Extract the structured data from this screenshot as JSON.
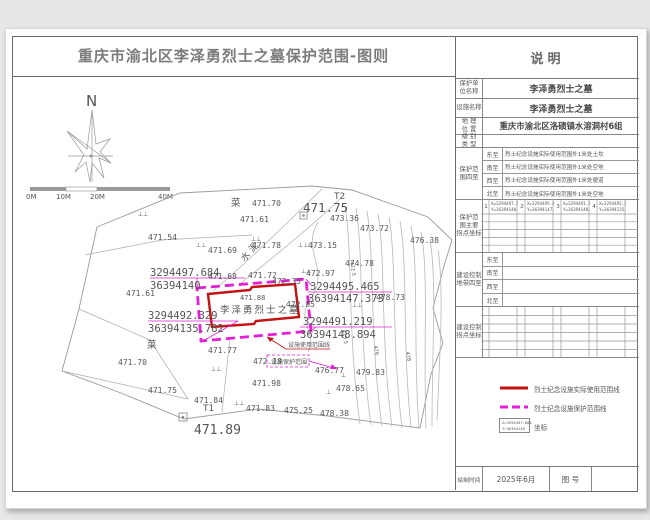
{
  "title": "重庆市渝北区李泽勇烈士之墓保护范围-图则",
  "colors": {
    "use_line_red": "#c41111",
    "protect_line_magenta": "#e51fd7",
    "map_linework": "#9a9a9a",
    "label_gray": "#555555"
  },
  "panel": {
    "header": "说明",
    "info_rows": [
      {
        "label_l1": "保护单",
        "label_l2": "位名称",
        "value": "李泽勇烈士之墓"
      },
      {
        "label_l1": "设施名称",
        "label_l2": "",
        "value": "李泽勇烈士之墓"
      },
      {
        "label_l1": "地 理",
        "label_l2": "位 置",
        "value": "重庆市渝北区洛碛镇水溶洞村6组"
      },
      {
        "label_l1": "级 别",
        "label_l2": "类 型",
        "value": ""
      }
    ],
    "scope": {
      "label_l1": "保护范",
      "label_l2": "围四至",
      "rows": [
        {
          "dir": "东至",
          "text": "烈士纪念设施实际使用范围外1米处土坎"
        },
        {
          "dir": "南至",
          "text": "烈士纪念设施实际使用范围外1米处空地"
        },
        {
          "dir": "西至",
          "text": "烈士纪念设施实际使用范围外1米处便道"
        },
        {
          "dir": "北至",
          "text": "烈士纪念设施实际使用范围外1米处空地"
        }
      ]
    },
    "scope_points": {
      "label_l1": "保护范",
      "label_l2": "围主要",
      "label_l3": "拐点坐标",
      "points": [
        {
          "no": "1",
          "x": "X=3294497.684",
          "y": "Y=36394140"
        },
        {
          "no": "2",
          "x": "X=3294495.465",
          "y": "Y=36394147.373"
        },
        {
          "no": "3",
          "x": "X=3294491.219",
          "y": "Y=36394148.894"
        },
        {
          "no": "4",
          "x": "X=3294492.329",
          "y": "Y=36394135.782"
        }
      ]
    },
    "control_scope": {
      "label_l1": "建设控制",
      "label_l2": "地带四至",
      "dirs": [
        "东至",
        "南至",
        "西至",
        "北至"
      ]
    },
    "control_points": {
      "label_l1": "建设控制",
      "label_l2": "拐点坐标"
    },
    "legend": {
      "use_line_label": "烈士纪念设施实际使用范围线",
      "protect_line_label": "烈士纪念设施保护范围线",
      "coord_sample_x": "X=3294497.684",
      "coord_sample_y": "Y=36394140",
      "coord_label": "坐标"
    },
    "footer": {
      "time_label": "绘制时间",
      "time_value": "2025年6月",
      "no_label": "图  号",
      "no_value": ""
    }
  },
  "map": {
    "north": "N",
    "scale": [
      "0M",
      "10M",
      "20M",
      "40M"
    ],
    "tomb": "李泽勇烈士之墓",
    "tomb_height": "471.88",
    "road": "水泥",
    "field1": "菜",
    "field2": "菜",
    "t1": "T1",
    "t2": "T2",
    "big1": "471.75",
    "big2": "471.89",
    "ann_use": "设施使用范围线",
    "ann_protect": "设施保护范围",
    "coord1a": "3294497.684",
    "coord1b": "36394140",
    "coord2a": "3294495.465",
    "coord2b": "36394147.373",
    "coord3a": "3294491.219",
    "coord3b": "36394148.894",
    "coord4a": "3294492.329",
    "coord4b": "36394135.782",
    "contour_labels": [
      "472.5",
      "473.5",
      "476",
      "478"
    ],
    "spots": [
      "471.70",
      "471.61",
      "473.36",
      "473.72",
      "476.38",
      "471.54",
      "471.69",
      "471.78",
      "473.15",
      "474.78",
      "472.97",
      "471.68",
      "471.72",
      "472.33",
      "472.85",
      "478.73",
      "471.61",
      "471.77",
      "472.18",
      "476.77",
      "479.83",
      "471.98",
      "478.65",
      "471.75",
      "471.84",
      "471.83",
      "475.25",
      "478.38",
      "471.70"
    ]
  }
}
